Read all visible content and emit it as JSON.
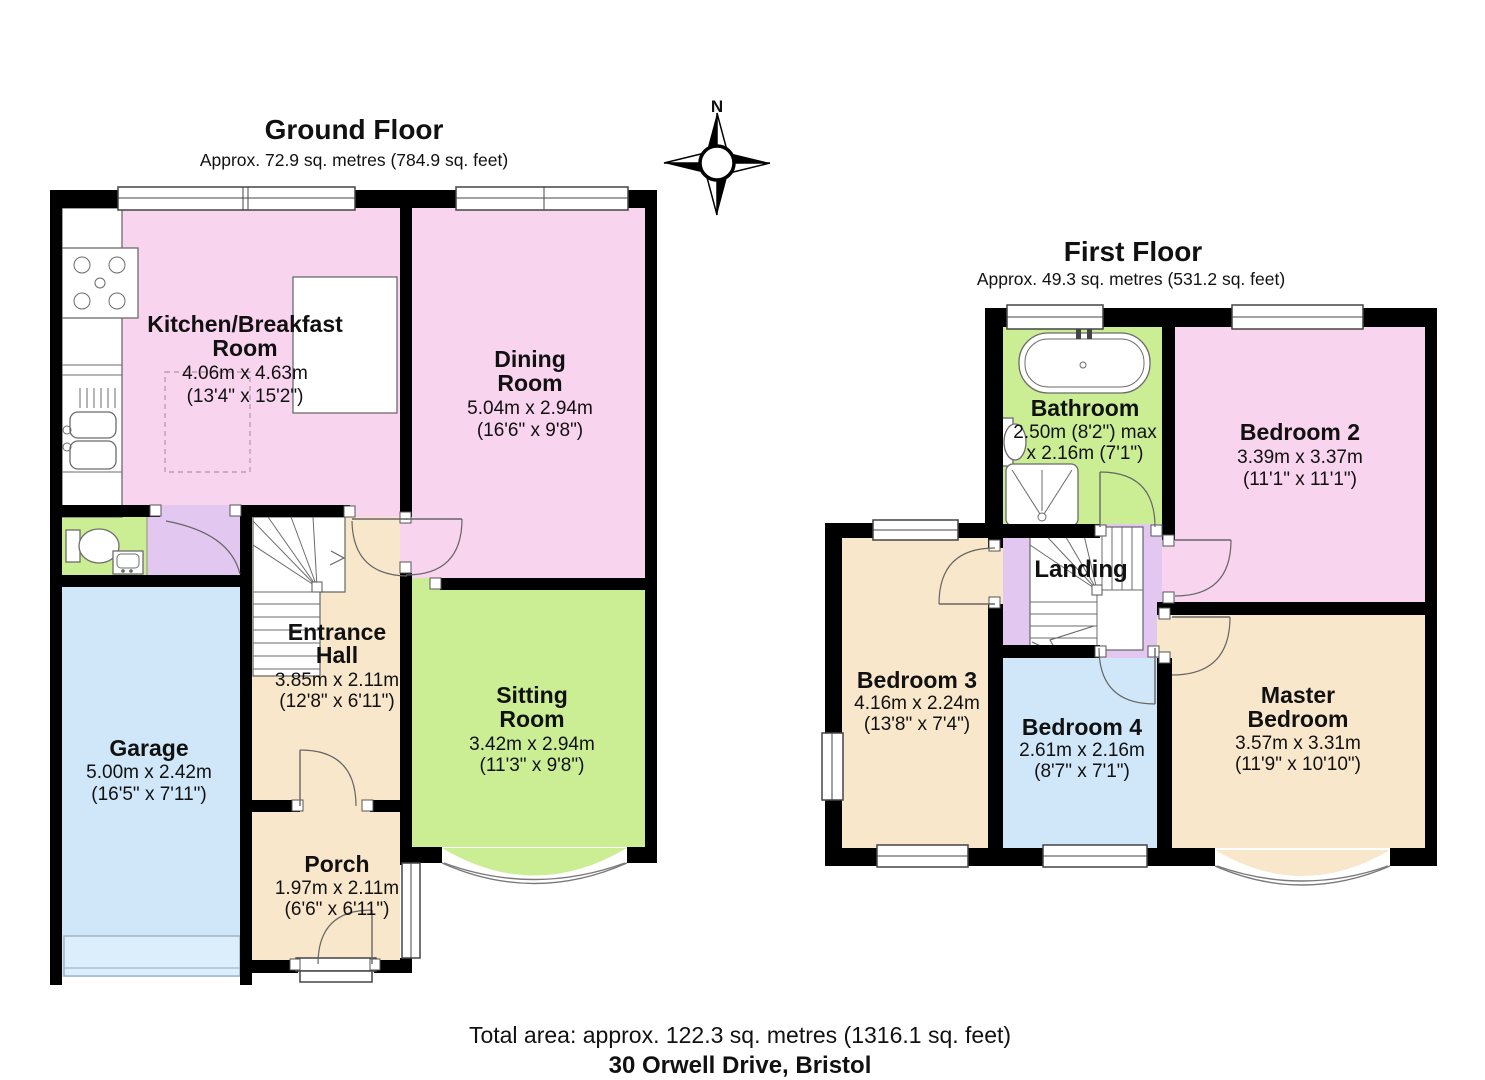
{
  "meta": {
    "total_area": "Total area: approx. 122.3 sq. metres (1316.1 sq. feet)",
    "address": "30 Orwell Drive, Bristol"
  },
  "compass": {
    "north_label": "N"
  },
  "ground_floor": {
    "title": "Ground Floor",
    "subtitle": "Approx. 72.9 sq. metres (784.9 sq. feet)",
    "rooms": {
      "kitchen": {
        "name_line1": "Kitchen/Breakfast",
        "name_line2": "Room",
        "metric": "4.06m x 4.63m",
        "imperial": "(13'4\" x 15'2\")"
      },
      "dining": {
        "name_line1": "Dining",
        "name_line2": "Room",
        "metric": "5.04m x 2.94m",
        "imperial": "(16'6\" x 9'8\")"
      },
      "sitting": {
        "name_line1": "Sitting",
        "name_line2": "Room",
        "metric": "3.42m x 2.94m",
        "imperial": "(11'3\" x 9'8\")"
      },
      "entrance": {
        "name_line1": "Entrance",
        "name_line2": "Hall",
        "metric": "3.85m x 2.11m",
        "imperial": "(12'8\" x 6'11\")"
      },
      "garage": {
        "name_line1": "Garage",
        "metric": "5.00m x 2.42m",
        "imperial": "(16'5\" x 7'11\")"
      },
      "porch": {
        "name_line1": "Porch",
        "metric": "1.97m x 2.11m",
        "imperial": "(6'6\" x 6'11\")"
      }
    }
  },
  "first_floor": {
    "title": "First Floor",
    "subtitle": "Approx. 49.3 sq. metres (531.2 sq. feet)",
    "rooms": {
      "bathroom": {
        "name_line1": "Bathroom",
        "metric": "2.50m (8'2\") max",
        "imperial": "x 2.16m (7'1\")"
      },
      "bedroom2": {
        "name_line1": "Bedroom 2",
        "metric": "3.39m x 3.37m",
        "imperial": "(11'1\" x 11'1\")"
      },
      "bedroom3": {
        "name_line1": "Bedroom 3",
        "metric": "4.16m x 2.24m",
        "imperial": "(13'8\" x 7'4\")"
      },
      "bedroom4": {
        "name_line1": "Bedroom 4",
        "metric": "2.61m x 2.16m",
        "imperial": "(8'7\" x 7'1\")"
      },
      "master": {
        "name_line1": "Master",
        "name_line2": "Bedroom",
        "metric": "3.57m x 3.31m",
        "imperial": "(11'9\" x 10'10\")"
      },
      "landing": {
        "name_line1": "Landing"
      }
    }
  },
  "palette": {
    "room_pink": "#F8D4EE",
    "room_green": "#CBEE95",
    "room_beige": "#F9E7CB",
    "room_blue": "#CFE7F8",
    "room_lavender": "#E2C7F1",
    "garage_door": "#DCEDFB",
    "wall": "#000000",
    "fixture_outline": "#666666"
  }
}
